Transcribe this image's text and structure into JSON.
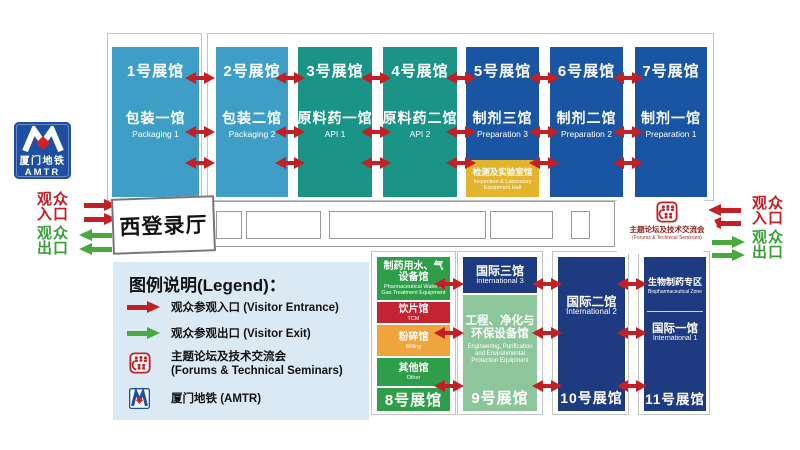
{
  "top_halls": [
    {
      "no": "1号展馆",
      "name": "包装一馆",
      "en": "Packaging 1"
    },
    {
      "no": "2号展馆",
      "name": "包装二馆",
      "en": "Packaging 2"
    },
    {
      "no": "3号展馆",
      "name": "原料药一馆",
      "en": "API 1"
    },
    {
      "no": "4号展馆",
      "name": "原料药二馆",
      "en": "API 2"
    },
    {
      "no": "5号展馆",
      "name": "制剂三馆",
      "en": "Preparation 3"
    },
    {
      "no": "6号展馆",
      "name": "制剂二馆",
      "en": "Preparation 2"
    },
    {
      "no": "7号展馆",
      "name": "制剂一馆",
      "en": "Preparation 1"
    }
  ],
  "inspection_hall": {
    "name": "检测及实验室馆",
    "en": "Inspection & Laboratory Equipment Hall"
  },
  "west_hall": {
    "name": "西登录厅"
  },
  "seminars": {
    "name": "主题论坛及技术交流会",
    "en": "(Forums & Technical Seminars)"
  },
  "amtr": {
    "name": "厦门地铁",
    "en": "AMTR"
  },
  "entrance": {
    "text": "观众\n入口"
  },
  "exit": {
    "text": "观众\n出口"
  },
  "legend": {
    "title": "图例说明(Legend)：",
    "entrance": "观众参观入口 (Visitor Entrance)",
    "exit": "观众参观出口 (Visitor Exit)",
    "seminars_cn": "主题论坛及技术交流会",
    "seminars_en": "(Forums & Technical Seminars)",
    "amtr": "厦门地铁 (AMTR)"
  },
  "bottom_halls": {
    "hall8": {
      "sections": [
        {
          "name": "制药用水、气设备馆",
          "en": "Pharmaceutical Water & Gas Treatment Equipment"
        },
        {
          "name": "饮片馆",
          "en": "TCM"
        },
        {
          "name": "粉碎馆",
          "en": "Milling"
        },
        {
          "name": "其他馆",
          "en": "Other"
        }
      ],
      "label": "8号展馆"
    },
    "hall9": {
      "top": {
        "name": "国际三馆",
        "en": "International 3"
      },
      "main": {
        "name": "工程、净化与环保设备馆",
        "en": "Engineering, Purification and Environmental Protection Equipment"
      },
      "label": "9号展馆"
    },
    "hall10": {
      "name": "国际二馆",
      "en": "International 2",
      "label": "10号展馆"
    },
    "hall11": {
      "zone": {
        "name": "生物制药专区",
        "en": "Biopharmaceutical Zone"
      },
      "main": {
        "name": "国际一馆",
        "en": "International 1"
      },
      "label": "11号展馆"
    }
  },
  "colors": {
    "packaging_blue": "#3f9ec5",
    "api_teal": "#1a9486",
    "prep_blue": "#1a55a4",
    "inspection_yellow": "#e4b42c",
    "navy": "#1e3a80",
    "green": "#2f9e4a",
    "tcm_red": "#c42332",
    "milling_orange": "#f0a43c",
    "light_green": "#8dc69b",
    "legend_bg": "#dbe9f5",
    "arrow_red": "#c32025",
    "arrow_green": "#48a93c",
    "amtr_blue": "#1d4fa2"
  }
}
